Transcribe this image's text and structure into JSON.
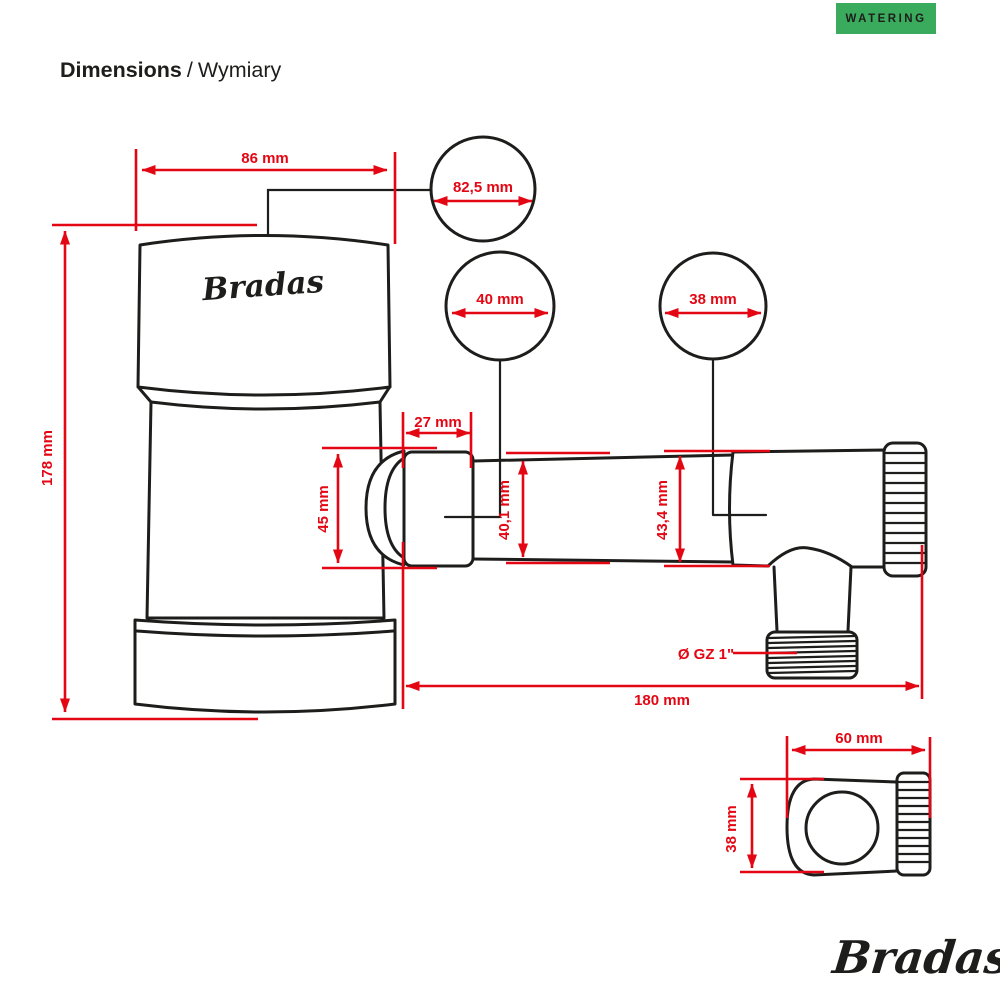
{
  "badge": {
    "label": "WATERING"
  },
  "title": {
    "primary": "Dimensions",
    "separator": "/",
    "secondary": "Wymiary"
  },
  "colors": {
    "accent_red": "#e30613",
    "badge_green": "#3aaa5c",
    "line_black": "#1d1d1b",
    "background": "#ffffff"
  },
  "drawing": {
    "product_logo": "Bradas",
    "dims": {
      "top_width": "86 mm",
      "lid_diameter": "82,5 mm",
      "left_connector_diameter": "40 mm",
      "right_connector_diameter": "38 mm",
      "connector_length": "27 mm",
      "connector_height": "45 mm",
      "pipe_inner_left": "40,1 mm",
      "pipe_inner_right": "43,4 mm",
      "total_height": "178 mm",
      "total_length": "180 mm",
      "outlet_thread": "Ø GZ 1\"",
      "side_view_length": "60 mm",
      "side_view_height": "38 mm"
    }
  },
  "footer": {
    "brand": "Bradas",
    "brand_mark": "®"
  }
}
